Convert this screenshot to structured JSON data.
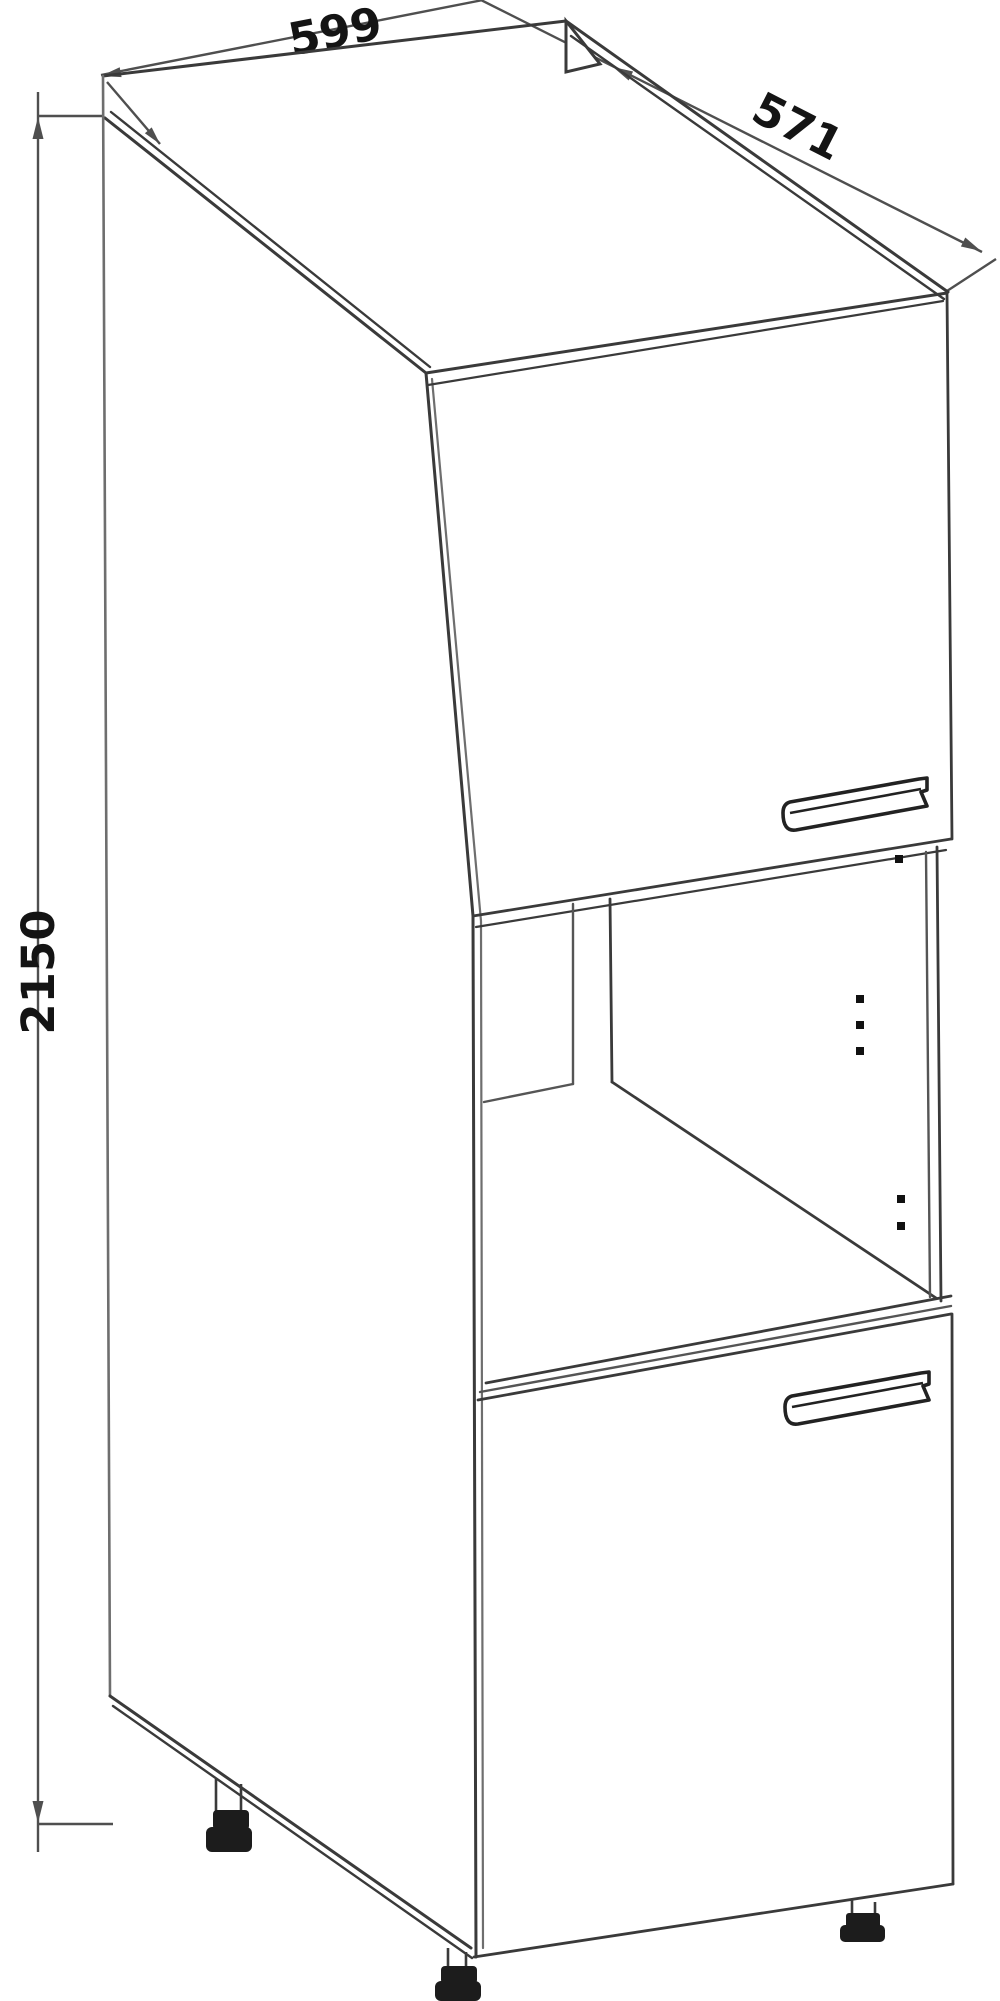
{
  "page": {
    "background": "#ffffff"
  },
  "diagram": {
    "type": "furniture-dimension-line-drawing",
    "subject": "tall-oven-housing-kitchen-cabinet",
    "view": "isometric-front-left",
    "labels": {
      "width": "599",
      "depth": "571",
      "height": "2150"
    },
    "colors": {
      "background": "#ffffff",
      "line_dark": "#3a3a3a",
      "line_light": "#7d7d7d",
      "dimension_line": "#4f4f4f",
      "text": "#141414",
      "foot_fill": "#1c1c1c"
    },
    "content": {
      "doors": 2,
      "open_niche": 1,
      "visible_feet": 3,
      "hinge_holes": 6,
      "handles": 2
    }
  }
}
